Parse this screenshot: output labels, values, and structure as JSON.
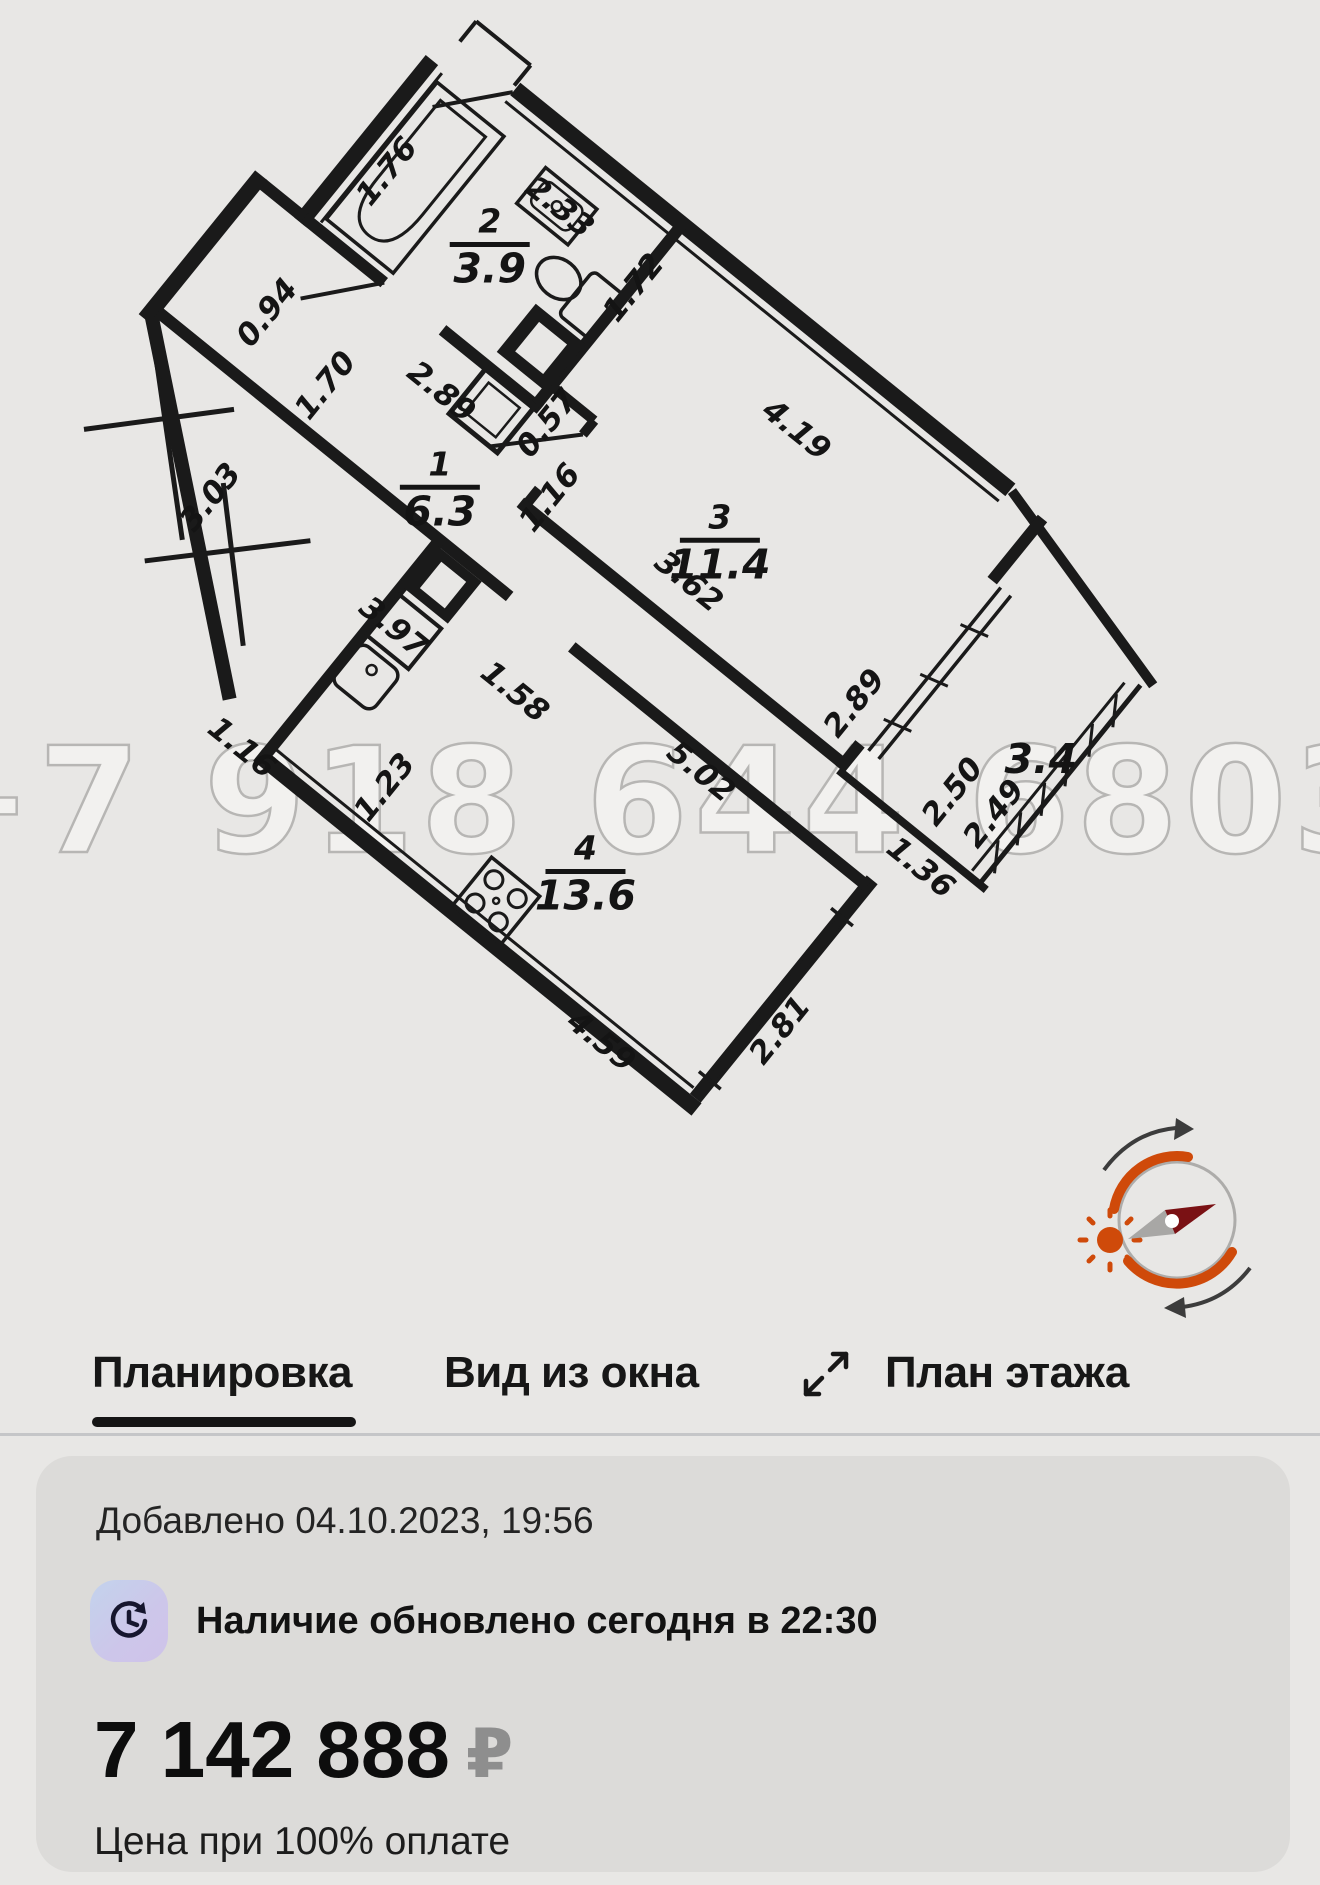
{
  "watermark": "+7 918 644 6803",
  "tabs": {
    "tab1": "Планировка",
    "tab2": "Вид из окна",
    "tab3": "План этажа"
  },
  "card": {
    "added": "Добавлено 04.10.2023, 19:56",
    "availability": "Наличие обновлено сегодня в 22:30",
    "price": "7 142 888",
    "currency": "₽",
    "price_note": "Цена при 100% оплате"
  },
  "colors": {
    "accent_orange": "#cf4a0a",
    "needle_red": "#7a1114",
    "card_bg": "#dcdbd9",
    "page_bg": "#e8e7e5"
  },
  "plan": {
    "rooms": [
      {
        "num": "2",
        "area": "3.9",
        "a": 153,
        "b": 129
      },
      {
        "num": "1",
        "area": "6.3",
        "a": 267,
        "b": 349
      },
      {
        "num": "3",
        "area": "11.4",
        "a": 518,
        "b": 214
      },
      {
        "num": "4",
        "area": "13.6",
        "a": 622,
        "b": 556
      },
      {
        "num": "",
        "area": "3.4",
        "a": 905,
        "b": 182
      }
    ],
    "dims": [
      {
        "t": "1.76",
        "a": 37,
        "b": 137,
        "r": -90
      },
      {
        "t": "2.33",
        "a": 184,
        "b": 66,
        "r": 0
      },
      {
        "t": "0.94",
        "a": 33,
        "b": 322,
        "r": -90
      },
      {
        "t": "1.70",
        "a": 124,
        "b": 342,
        "r": -90
      },
      {
        "t": "2.89",
        "a": 208,
        "b": 284,
        "r": 0
      },
      {
        "t": "0.57",
        "a": 320,
        "b": 232,
        "r": -90
      },
      {
        "t": "1.16",
        "a": 369,
        "b": 288,
        "r": -90
      },
      {
        "t": "1.72",
        "a": 302,
        "b": 72,
        "r": -90
      },
      {
        "t": "4.19",
        "a": 508,
        "b": 90,
        "r": 0
      },
      {
        "t": "3.62",
        "a": 520,
        "b": 276,
        "r": 0
      },
      {
        "t": "2.89",
        "a": 735,
        "b": 256,
        "r": -90
      },
      {
        "t": "2.50",
        "a": 867,
        "b": 263,
        "r": -90
      },
      {
        "t": "2.49",
        "a": 913,
        "b": 254,
        "r": -90
      },
      {
        "t": "1.36",
        "a": 880,
        "b": 352,
        "r": 0
      },
      {
        "t": "3.03",
        "a": 105,
        "b": 501,
        "r": -90
      },
      {
        "t": "3.97",
        "a": 319,
        "b": 497,
        "r": 0
      },
      {
        "t": "1.58",
        "a": 454,
        "b": 471,
        "r": 0
      },
      {
        "t": "1.16",
        "a": 277,
        "b": 686,
        "r": 0
      },
      {
        "t": "1.23",
        "a": 423,
        "b": 617,
        "r": -90
      },
      {
        "t": "5.02",
        "a": 649,
        "b": 416,
        "r": 0
      },
      {
        "t": "4.59",
        "a": 741,
        "b": 688,
        "r": 0
      },
      {
        "t": "2.81",
        "a": 883,
        "b": 557,
        "r": -90
      }
    ],
    "rotation_deg": 39
  }
}
